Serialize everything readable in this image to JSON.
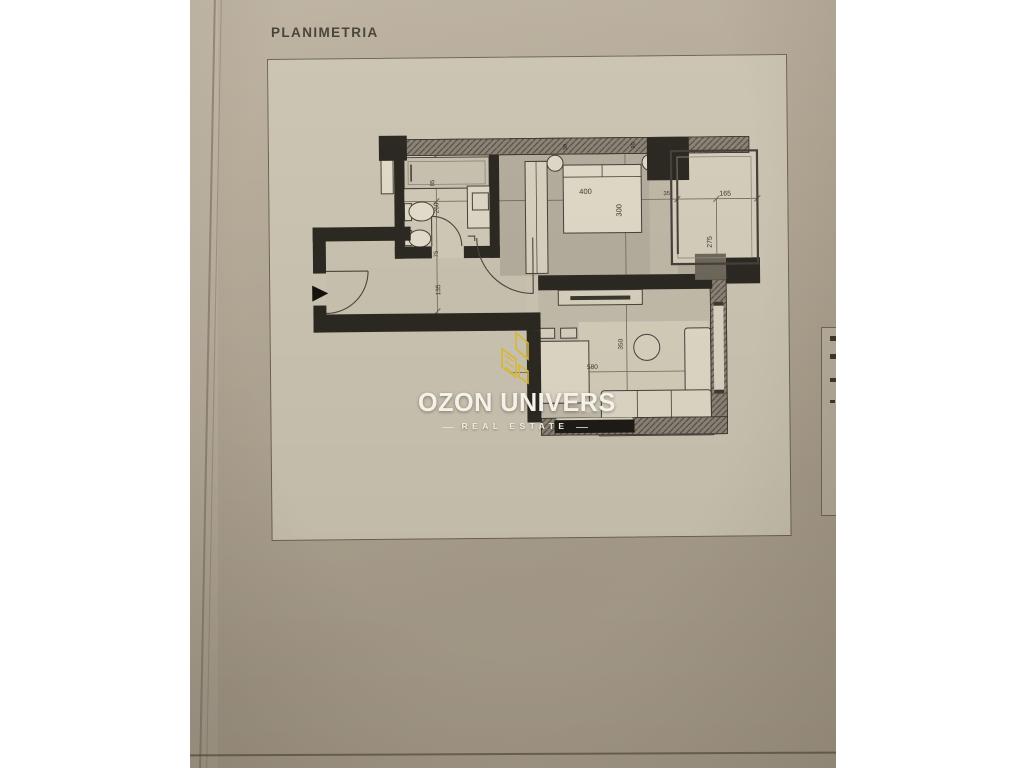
{
  "title": "PLANIMETRIA",
  "watermark": {
    "brand": "OZON UNIVERS",
    "tagline": "REAL ESTATE"
  },
  "plan": {
    "dims": {
      "bed_w": "400",
      "bed_d": "300",
      "balcony_w": "165",
      "balcony_d": "275",
      "gap": "35",
      "bath_top": "85",
      "bath_len": "260",
      "bath_door": "75",
      "hall": "135",
      "living_w": "580",
      "living_d": "350",
      "wall_a": "30",
      "wall_b": "30"
    }
  },
  "colors": {
    "gold": "#d7b732",
    "paper": "#cbc3b1",
    "wall_dark": "#2c2923",
    "wall_hatched": "#8b8376"
  }
}
